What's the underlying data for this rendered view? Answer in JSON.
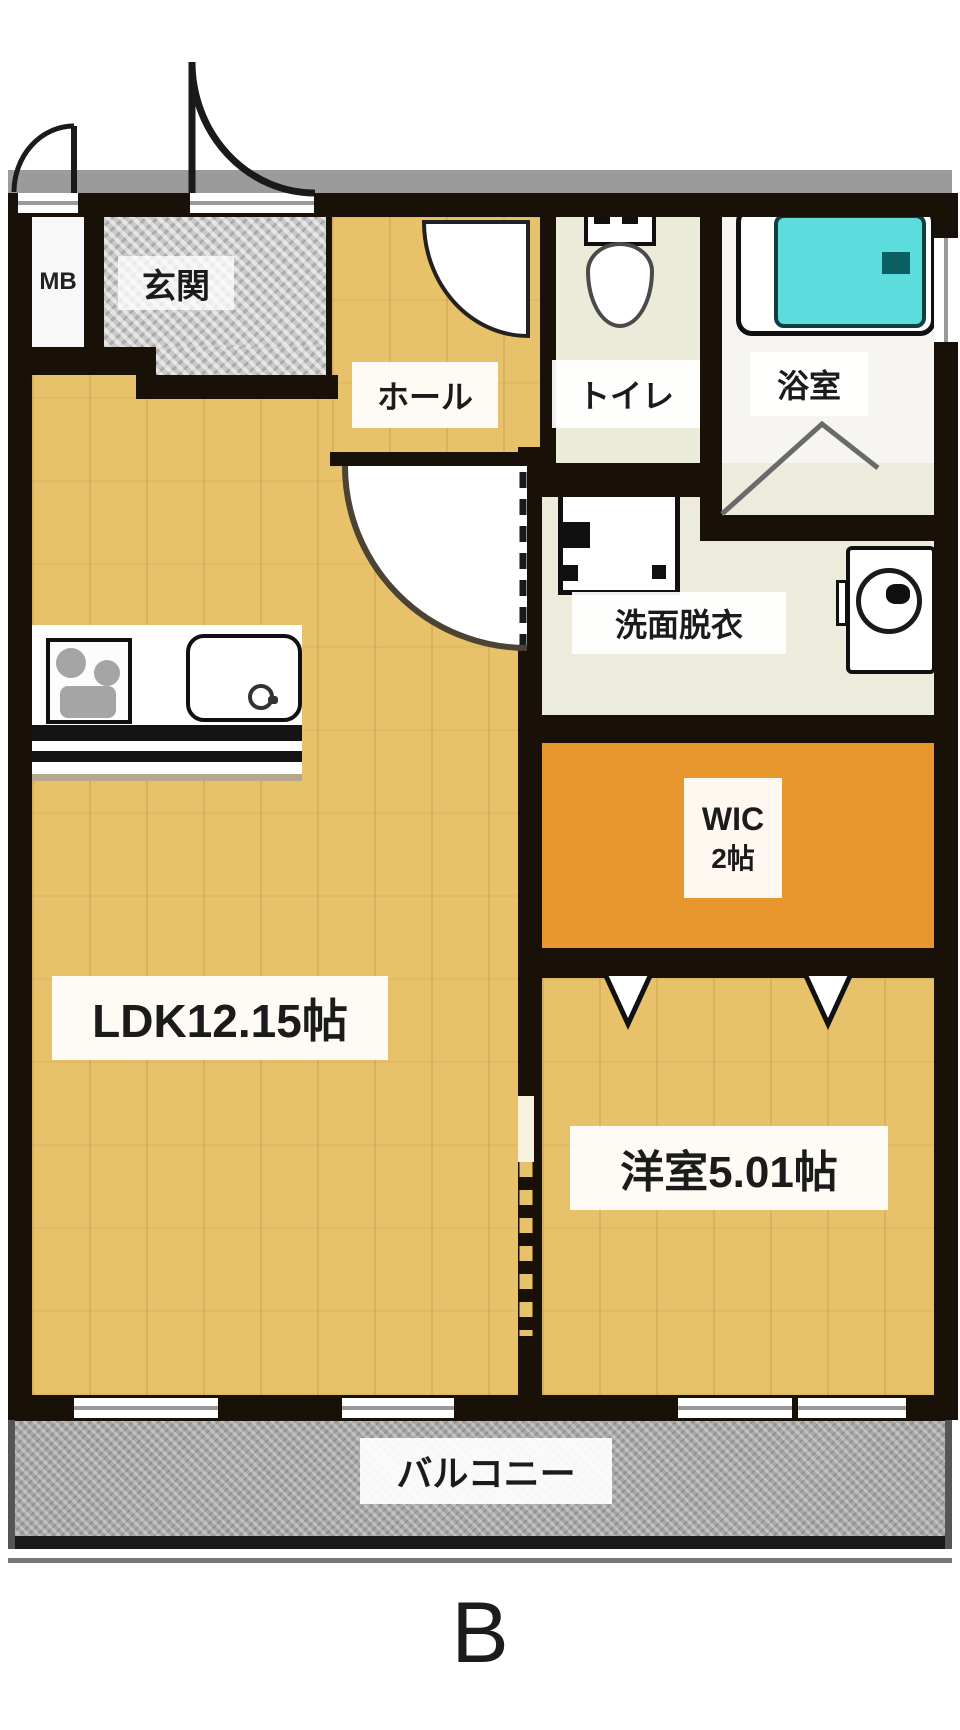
{
  "labels": {
    "mb": "MB",
    "entrance": "玄関",
    "hall": "ホール",
    "toilet": "トイレ",
    "bath": "浴室",
    "washroom": "洗面脱衣",
    "wic_name": "WIC",
    "wic_size": "2帖",
    "ldk": "LDK12.15帖",
    "bedroom": "洋室5.01帖",
    "balcony": "バルコニー",
    "unit": "B"
  },
  "colors": {
    "wall": "#191008",
    "wood": "#e8c26a",
    "tile": "#c9c9c9",
    "toilet_floor": "#ecead9",
    "washroom_floor": "#edebdc",
    "bath_floor": "#f6f5f1",
    "wic_floor": "#e8962e",
    "balcony_floor": "#a7a7a7",
    "bathtub": "#5cdcdd"
  }
}
